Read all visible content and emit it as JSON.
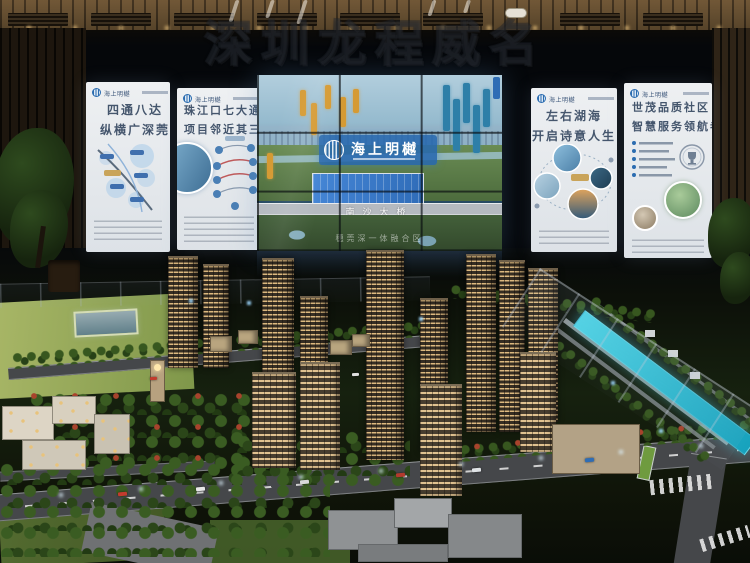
{
  "watermark": {
    "text": "深圳龙程威名"
  },
  "brand": {
    "name": "海上明樾",
    "logo_color": "#2b6cb0"
  },
  "panels": {
    "p1": {
      "logo": "海上明樾",
      "title1": "四通八达",
      "title2": "纵横广深莞"
    },
    "p2": {
      "logo": "海上明樾",
      "title1": "珠江口七大通道",
      "title2": "项目邻近其三"
    },
    "p3": {
      "logo": "海上明樾",
      "title1": "左右湖海",
      "title2": "开启诗意人生"
    },
    "p4": {
      "logo": "海上明樾",
      "title1": "世茂品质社区",
      "title2": "智慧服务领航者"
    }
  },
  "center_screen": {
    "logo_text": "海上明樾",
    "bridge_label": "南沙大桥",
    "area_label": "穗莞深一体融合区"
  },
  "colors": {
    "accent_blue": "#2b6cb0",
    "canal_cyan": "#3fd0e4",
    "tag_orange": "#d59a33",
    "tag_teal": "#2e7fa8",
    "lawn_green": "#9aae5f",
    "tower_beige": "#b59f7d",
    "window_glow": "#ffd98a",
    "poster_bg": "#e9ecef"
  }
}
